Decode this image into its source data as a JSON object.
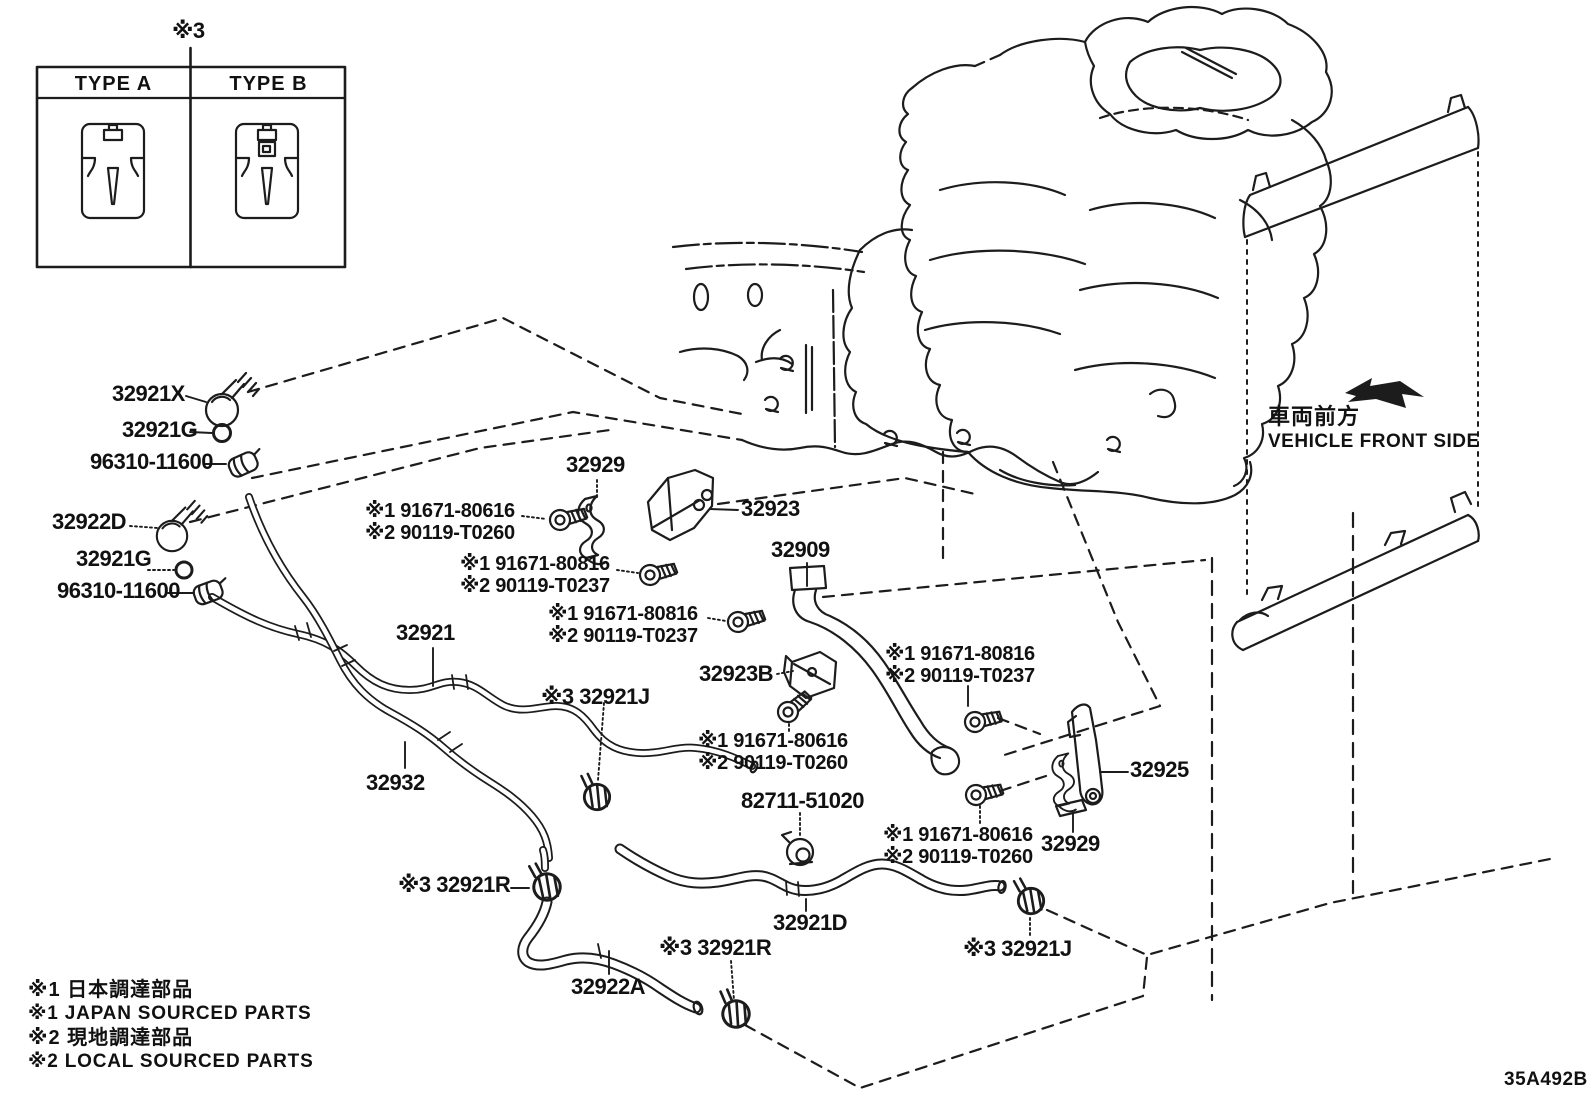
{
  "figure_code": "35A492B",
  "type_table": {
    "note_ref": "※3",
    "type_a": "TYPE A",
    "type_b": "TYPE B"
  },
  "direction_indicator": {
    "jp": "車両前方",
    "en": "VEHICLE FRONT SIDE"
  },
  "notes": [
    "※1 日本調達部品",
    "※1 JAPAN SOURCED PARTS",
    "※2 現地調達部品",
    "※2 LOCAL SOURCED PARTS"
  ],
  "labels": [
    {
      "text": "32921X"
    },
    {
      "text": "32921G"
    },
    {
      "text": "96310-11600"
    },
    {
      "text": "32922D"
    },
    {
      "text": "32921G"
    },
    {
      "text": "96310-11600"
    },
    {
      "text": "32921"
    },
    {
      "text": "32932"
    },
    {
      "text": "※3 32921J"
    },
    {
      "text": "32929"
    },
    {
      "text": "32923"
    },
    {
      "text": "※1 91671-80616"
    },
    {
      "text": "※2 90119-T0260"
    },
    {
      "text": "※1 91671-80816"
    },
    {
      "text": "※2 90119-T0237"
    },
    {
      "text": "※1 91671-80816"
    },
    {
      "text": "※2 90119-T0237"
    },
    {
      "text": "32909"
    },
    {
      "text": "32923B"
    },
    {
      "text": "※1 91671-80616"
    },
    {
      "text": "※2 90119-T0260"
    },
    {
      "text": "※1 91671-80816"
    },
    {
      "text": "※2 90119-T0237"
    },
    {
      "text": "82711-51020"
    },
    {
      "text": "※1 91671-80616"
    },
    {
      "text": "※2 90119-T0260"
    },
    {
      "text": "32925"
    },
    {
      "text": "32929"
    },
    {
      "text": "32921D"
    },
    {
      "text": "※3 32921R"
    },
    {
      "text": "32922A"
    },
    {
      "text": "※3 32921R"
    },
    {
      "text": "※3 32921J"
    }
  ],
  "colors": {
    "line": "#1c1c1c",
    "background": "#ffffff"
  }
}
